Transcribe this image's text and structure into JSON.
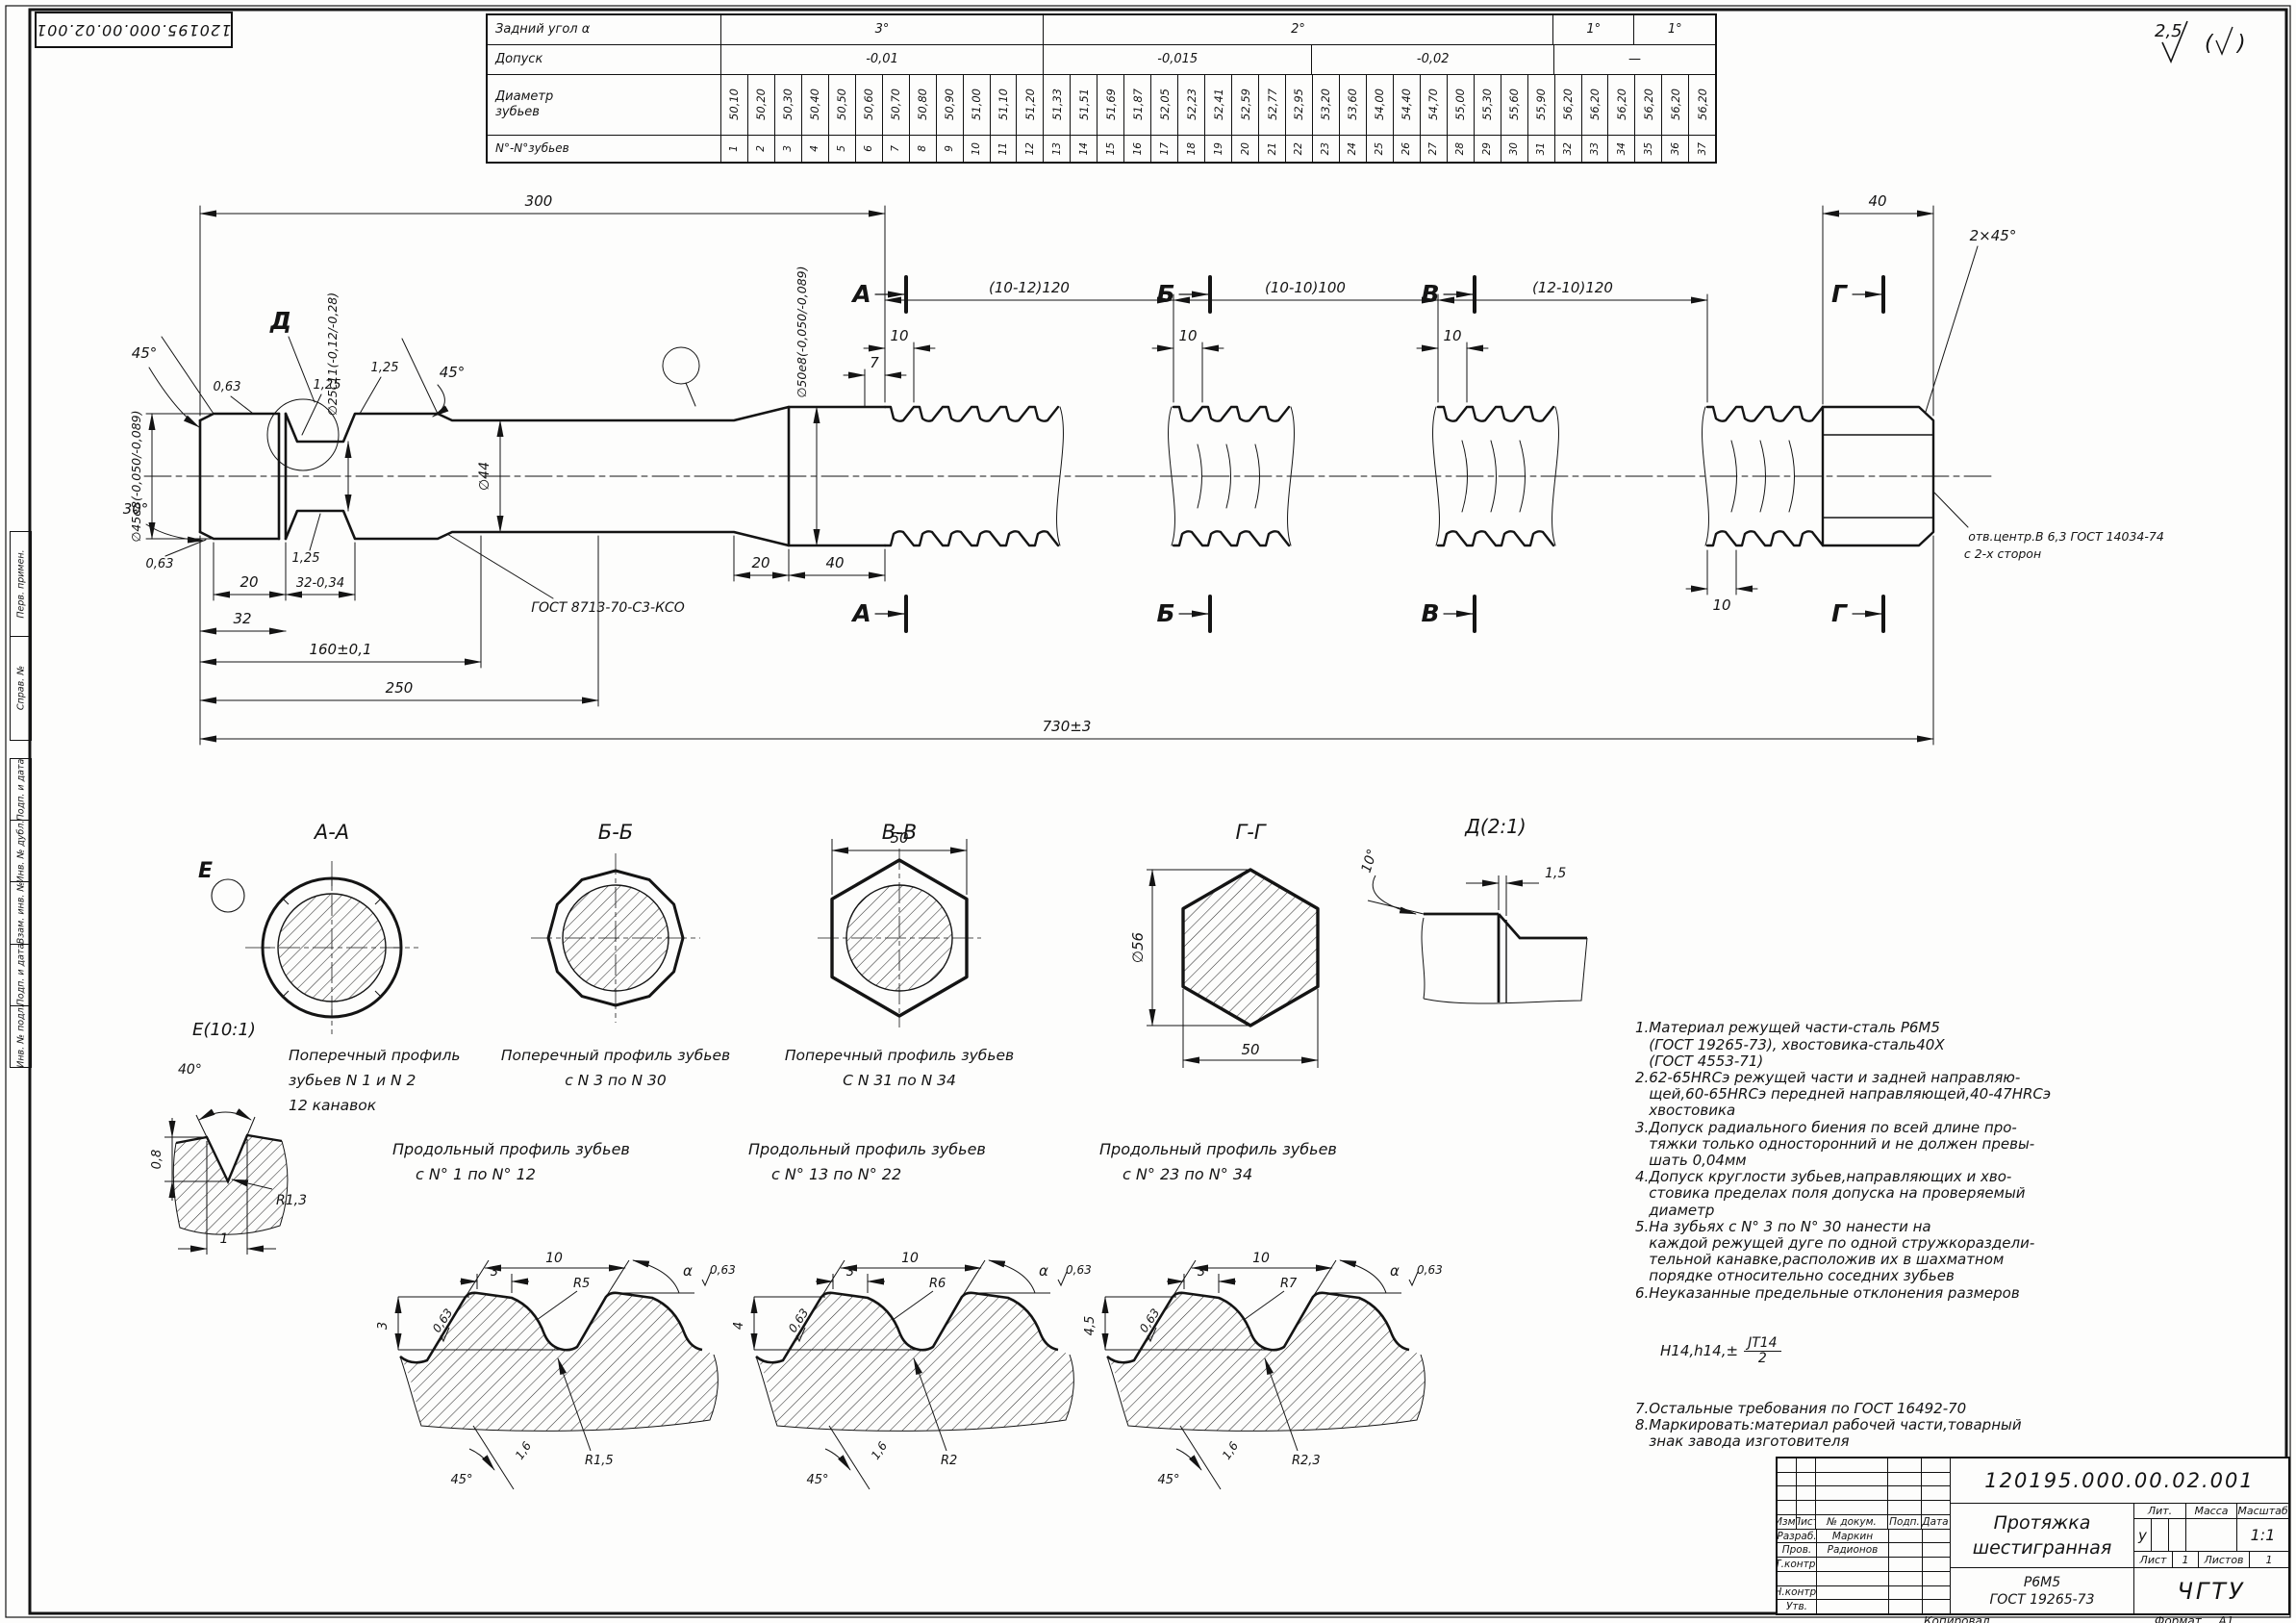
{
  "sheet": {
    "doc_number": "120195.000.00.02.001",
    "roughness": "2,5",
    "copied_label": "Копировал",
    "format_label": "Формат",
    "format_value": "А1"
  },
  "side_stamps": {
    "group1": [
      "Перв. примен.",
      "Справ. №"
    ],
    "group2": [
      "Подп. и дата",
      "Инв. № дубл.",
      "Взам. инв. №",
      "Подп. и дата",
      "Инв. № подл."
    ]
  },
  "tooth_table": {
    "labels": {
      "angle": "Задний угол α",
      "tolerance": "Допуск",
      "diameter_1": "Диаметр",
      "diameter_2": "зубьев",
      "numbers": "N°-N°зубьев"
    },
    "angles": [
      "3°",
      "2°",
      "1°",
      "1°"
    ],
    "tolerances": [
      "-0,01",
      "-0,015",
      "-0,02",
      "—"
    ],
    "diameters": [
      "50,10",
      "50,20",
      "50,30",
      "50,40",
      "50,50",
      "50,60",
      "50,70",
      "50,80",
      "50,90",
      "51,00",
      "51,10",
      "51,20",
      "51,33",
      "51,51",
      "51,69",
      "51,87",
      "52,05",
      "52,23",
      "52,41",
      "52,59",
      "52,77",
      "52,95",
      "53,20",
      "53,60",
      "54,00",
      "54,40",
      "54,70",
      "55,00",
      "55,30",
      "55,60",
      "55,90",
      "56,20",
      "56,20",
      "56,20",
      "56,20",
      "56,20",
      "56,20"
    ],
    "numbers": [
      "1",
      "2",
      "3",
      "4",
      "5",
      "6",
      "7",
      "8",
      "9",
      "10",
      "11",
      "12",
      "13",
      "14",
      "15",
      "16",
      "17",
      "18",
      "19",
      "20",
      "21",
      "22",
      "23",
      "24",
      "25",
      "26",
      "27",
      "28",
      "29",
      "30",
      "31",
      "32",
      "33",
      "34",
      "35",
      "36",
      "37"
    ]
  },
  "main": {
    "dim300": "300",
    "dimG1": "(10-12)120",
    "dimG2": "(10-10)100",
    "dimG3": "(12-10)120",
    "dim40tail": "40",
    "chamfer": "2×45°",
    "dim10a": "10",
    "dim7": "7",
    "dim10b": "10",
    "dim10c": "10",
    "dim10d": "10",
    "dim20a": "20",
    "dim32tol": "32-0,34",
    "dim32": "32",
    "dim20b": "20",
    "dim40b": "40",
    "dim160": "160±0,1",
    "dim250": "250",
    "dim730": "730±3",
    "dia45": "∅45e8(-0,050/-0,089)",
    "dia25": "∅25c11(-0,12/-0,28)",
    "dia44": "∅44",
    "dia50": "∅50e8(-0,050/-0,089)",
    "ang45a": "45°",
    "ang45b": "45°",
    "ang30": "30°",
    "r063a": "0,63",
    "r063b": "0,63",
    "r125a": "1,25",
    "r125b": "1,25",
    "r125c": "1,25",
    "weld": "ГОСТ 8713-70-С3-КСО",
    "center1": "отв.центр.В 6,3 ГОСТ 14034-74",
    "center2": "с 2-х сторон",
    "secA": "А",
    "secB": "Б",
    "secV": "В",
    "secG": "Г",
    "detD": "Д",
    "detE": "Е"
  },
  "sections": {
    "aa": {
      "title": "А-А",
      "cap1": "Поперечный профиль",
      "cap2": "зубьев N 1 и N 2",
      "cap3": "12 канавок"
    },
    "bb": {
      "title": "Б-Б",
      "cap1": "Поперечный профиль зубьев",
      "cap2": "с N 3 по N 30"
    },
    "vv": {
      "title": "В-В",
      "cap1": "Поперечный профиль зубьев",
      "cap2": "С N 31 по N 34",
      "dim50": "50"
    },
    "gg": {
      "title": "Г-Г",
      "dia": "∅56",
      "dim50": "50"
    },
    "dd": {
      "title": "Д(2:1)",
      "ang": "10°",
      "dim": "1,5"
    },
    "ee": {
      "title": "Е(10:1)",
      "ang": "40°",
      "depth": "0,8",
      "width": "1",
      "radius": "R1,3"
    }
  },
  "profiles": {
    "p1": {
      "t1": "Продольный профиль зубьев",
      "t2": "с N° 1 по N° 12",
      "pitch": "10",
      "land": "3",
      "h": "3",
      "backR": "R5",
      "gulletR": "R1,5",
      "alpha": "α",
      "r063": "0,63",
      "r063b": "0,63",
      "ang": "45°",
      "r16": "1,6"
    },
    "p2": {
      "t1": "Продольный профиль зубьев",
      "t2": "с N° 13 по N° 22",
      "pitch": "10",
      "land": "3",
      "h": "4",
      "backR": "R6",
      "gulletR": "R2",
      "alpha": "α",
      "r063": "0,63",
      "r063b": "0,63",
      "ang": "45°",
      "r16": "1,6"
    },
    "p3": {
      "t1": "Продольный профиль зубьев",
      "t2": "с N° 23 по N° 34",
      "pitch": "10",
      "land": "3",
      "h": "4,5",
      "backR": "R7",
      "gulletR": "R2,3",
      "alpha": "α",
      "r063": "0,63",
      "r063b": "0,63",
      "ang": "45°",
      "r16": "1,6"
    }
  },
  "tech": {
    "lines_a": [
      "1.Материал режущей части-сталь Р6М5",
      "   (ГОСТ 19265-73), хвостовика-сталь40Х",
      "   (ГОСТ 4553-71)",
      "2.62-65HRCэ режущей части и задней направляю-",
      "   щей,60-65HRCэ передней направляющей,40-47HRCэ",
      "   хвостовика",
      "3.Допуск радиального биения по всей длине про-",
      "   тяжки только односторонний и не должен превы-",
      "   шать 0,04мм",
      "4.Допуск круглости зубьев,направляющих и хво-",
      "   стовика пределах поля допуска на проверяемый",
      "   диаметр",
      "5.На зубьях с N° 3 по N° 30 нанести на",
      "   каждой режущей дуге по одной стружкораздели-",
      "   тельной канавке,расположив их в шахматном",
      "   порядке относительно соседних зубьев",
      "6.Неуказанные предельные отклонения размеров"
    ],
    "frac_prefix": "H14,h14,±",
    "frac_num": "JT14",
    "frac_den": "2",
    "lines_b": [
      "7.Остальные требования по ГОСТ 16492-70",
      "8.Маркировать:материал рабочей части,товарный",
      "   знак завода изготовителя"
    ]
  },
  "title_block": {
    "doc_number": "120195.000.00.02.001",
    "name_line1": "Протяжка",
    "name_line2": "шестигранная",
    "material_line1": "Р6М5",
    "material_line2": "ГОСТ 19265-73",
    "cols": [
      "Изм.",
      "Лист",
      "№ докум.",
      "Подп.",
      "Дата"
    ],
    "rows": [
      {
        "role": "Разраб.",
        "name": "Маркин"
      },
      {
        "role": "Пров.",
        "name": "Радионов"
      },
      {
        "role": "Т.контр.",
        "name": ""
      },
      {
        "role": "",
        "name": ""
      },
      {
        "role": "Н.контр.",
        "name": ""
      },
      {
        "role": "Утв.",
        "name": ""
      }
    ],
    "lit_label": "Лит.",
    "mass_label": "Масса",
    "scale_label": "Масштаб",
    "lit_value": "у",
    "mass_value": "",
    "scale_value": "1:1",
    "sheet_label": "Лист",
    "sheet_value": "1",
    "sheets_label": "Листов",
    "sheets_value": "1",
    "org": "ЧГТУ"
  }
}
